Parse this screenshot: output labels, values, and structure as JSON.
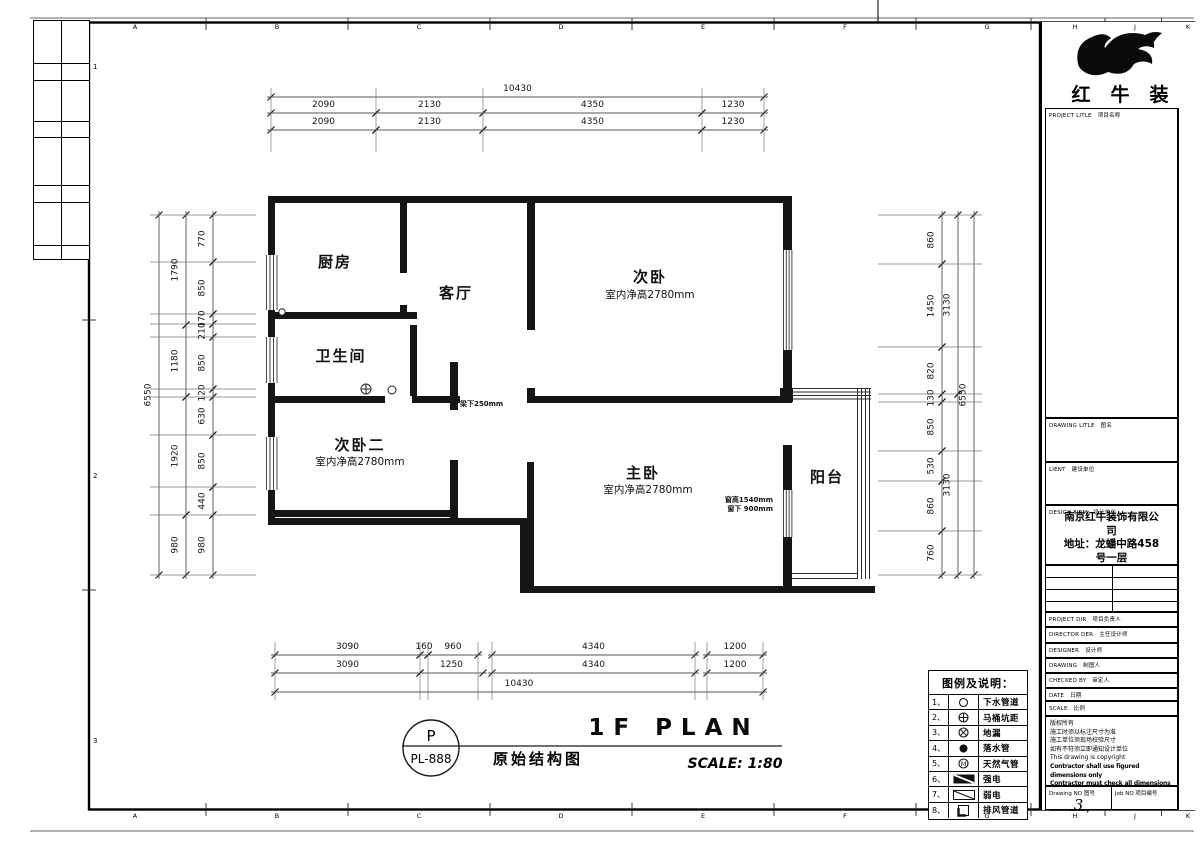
{
  "sheet": {
    "grid_letters": [
      "A",
      "B",
      "C",
      "D",
      "E",
      "F",
      "G",
      "H",
      "J",
      "K"
    ],
    "grid_numbers": [
      "1",
      "2",
      "3"
    ]
  },
  "plan": {
    "rooms": [
      {
        "name": "厨房"
      },
      {
        "name": "客厅"
      },
      {
        "name": "卫生间"
      },
      {
        "name": "次卧",
        "note": "室内净高2780mm"
      },
      {
        "name": "次卧二",
        "note": "室内净高2780mm"
      },
      {
        "name": "主卧",
        "note": "室内净高2780mm"
      },
      {
        "name": "阳台"
      }
    ],
    "annotations": {
      "beam": "梁下250mm",
      "window_height": "窗高1540mm",
      "window_sill": "窗下 900mm"
    }
  },
  "dims": {
    "top": {
      "total": "10430",
      "row1": [
        "2090",
        "2130",
        "4350",
        "1230"
      ],
      "row2": [
        "2090",
        "2130",
        "4350",
        "1230"
      ]
    },
    "bottom": {
      "row1": [
        "3090",
        "160",
        "960",
        "4340",
        "1200"
      ],
      "row2": [
        "3090",
        "1250",
        "4340",
        "1200"
      ],
      "total": "10430"
    },
    "left": {
      "inner": [
        "770",
        "850",
        "170",
        "210",
        "850",
        "120",
        "630",
        "850",
        "440",
        "980"
      ],
      "mid": [
        "1790",
        "1180",
        "1920",
        "980"
      ],
      "total": "6550"
    },
    "right": {
      "inner": [
        "860",
        "1450",
        "820",
        "130",
        "850",
        "530",
        "860",
        "760"
      ],
      "mid": [
        "3130",
        "3130"
      ],
      "total": "6550"
    }
  },
  "titles": {
    "stamp_top": "P",
    "stamp_no": "PL-888",
    "plan_title": "1F PLAN",
    "drawing_name": "原始结构图",
    "scale": "SCALE: 1:80"
  },
  "legend": {
    "header": "图例及说明：",
    "items": [
      {
        "no": "1、",
        "symbol": "circle-outline-icon",
        "label": "下水管道"
      },
      {
        "no": "2、",
        "symbol": "circle-cross-icon",
        "label": "马桶坑距"
      },
      {
        "no": "3、",
        "symbol": "circle-x-icon",
        "label": "地漏"
      },
      {
        "no": "4、",
        "symbol": "circle-filled-icon",
        "label": "落水管"
      },
      {
        "no": "5、",
        "symbol": "circle-m-icon",
        "label": "天然气管"
      },
      {
        "no": "6、",
        "symbol": "rect-filled-diagonal-icon",
        "label": "强电"
      },
      {
        "no": "7、",
        "symbol": "rect-diagonal-icon",
        "label": "弱电"
      },
      {
        "no": "8、",
        "symbol": "square-corner-icon",
        "label": "排风管道"
      }
    ]
  },
  "title_block": {
    "brand": "红牛装饰",
    "fields": [
      {
        "en": "PROJECT LITLE",
        "cn": "项目名称"
      },
      {
        "en": "DRAWING LITLE",
        "cn": "图名"
      },
      {
        "en": "LIENT",
        "cn": "建设单位"
      },
      {
        "en": "DESIGN FIRM",
        "cn": "设计单位"
      },
      {
        "en": "PROJECT DIR",
        "cn": "项目负责人"
      },
      {
        "en": "DIRECTOR DER",
        "cn": "主任设计师"
      },
      {
        "en": "DESIGNER",
        "cn": "设计师"
      },
      {
        "en": "DRAWING",
        "cn": "制图人"
      },
      {
        "en": "CHECKED BY",
        "cn": "审定人"
      },
      {
        "en": "DATE",
        "cn": "日期"
      },
      {
        "en": "SCALE",
        "cn": "比例"
      }
    ],
    "company_lines": [
      "南京红牛装饰有限公司",
      "地址：龙蟠中路458号一层"
    ],
    "notes": [
      "版权所有",
      "施工时须以标注尺寸为准",
      "施工单位须现场校验尺寸",
      "如有不符须立即通知设计单位",
      "This drawing is copyright",
      "Contractor shall use figured dimensions only",
      "Contractor must check all dimensions on site",
      "Any discrepancy must be reported immediately"
    ],
    "footer": {
      "drawing_no_en": "Drawing NO",
      "drawing_no_cn": "图号",
      "drawing_no_value": "3",
      "job_no_en": "Job NO",
      "job_no_cn": "项目编号"
    }
  }
}
